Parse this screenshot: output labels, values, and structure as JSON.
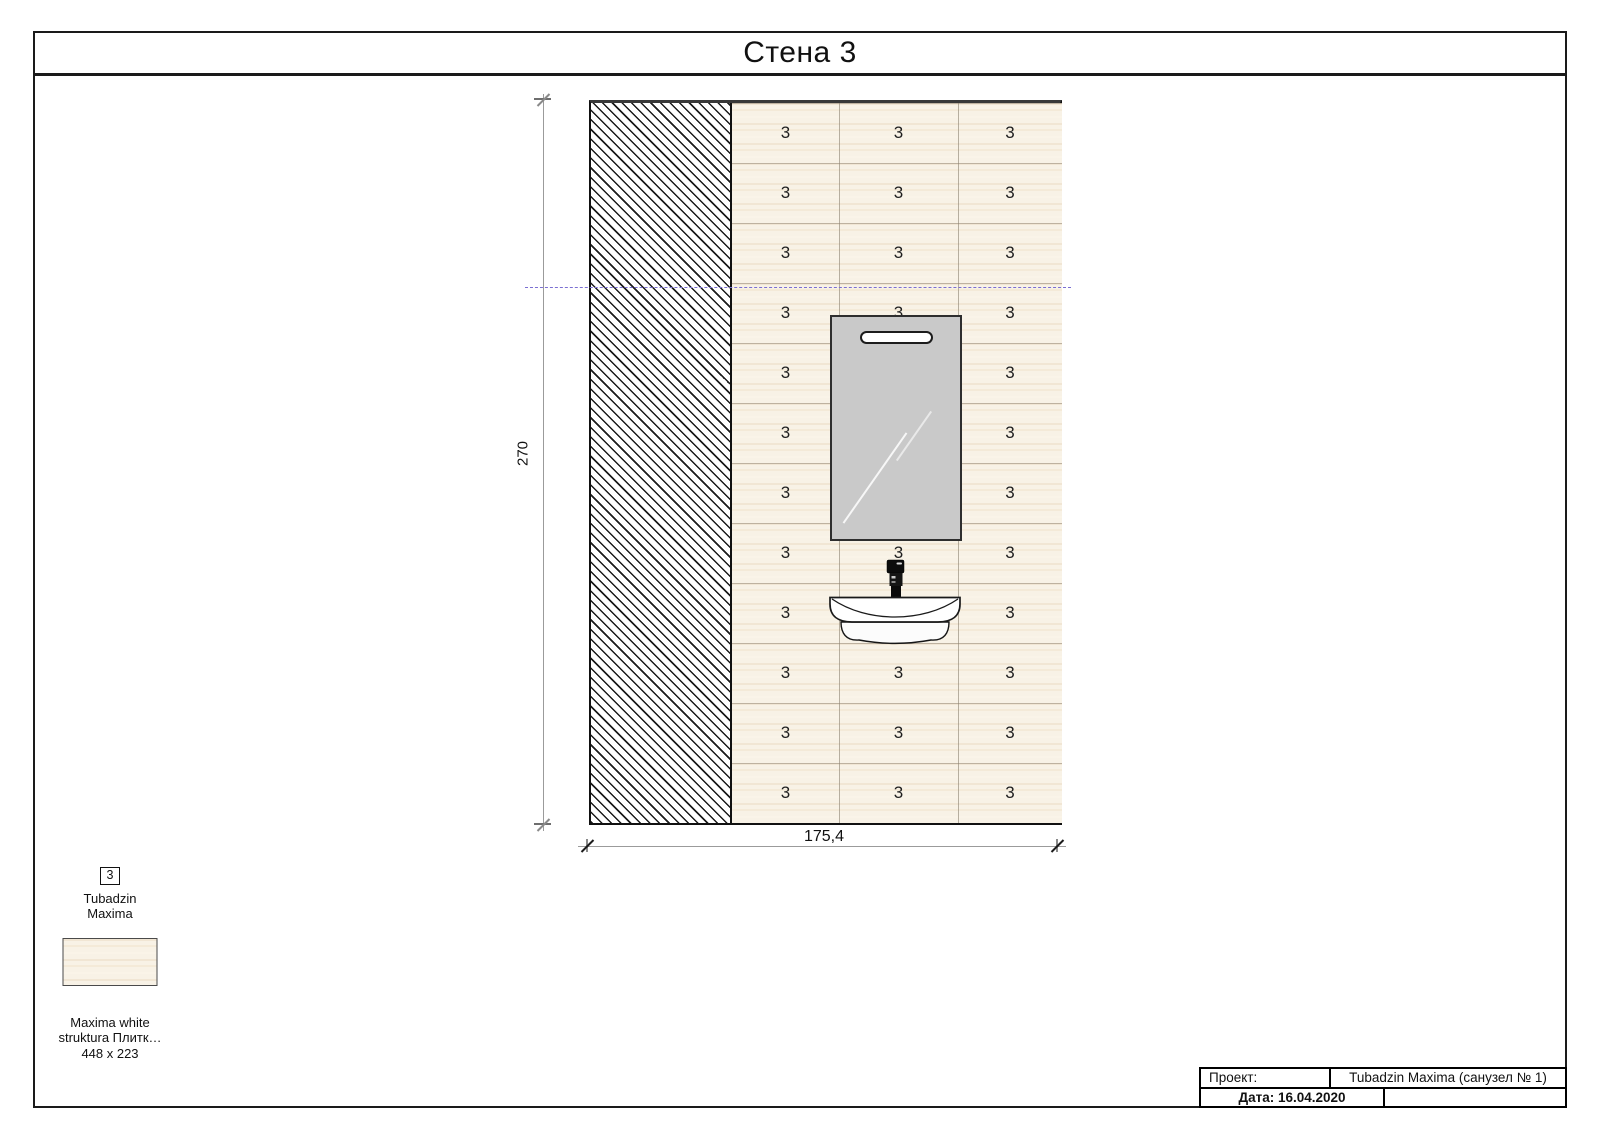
{
  "page": {
    "title": "Стена 3"
  },
  "drawing": {
    "tile_label": "3",
    "grid": {
      "rows": 12,
      "row_height": 60,
      "col_offsets": [
        0,
        107,
        226
      ],
      "col_widths": [
        107,
        119,
        104
      ]
    },
    "dimensions": {
      "height": "270",
      "width": "175,4"
    }
  },
  "legend": {
    "tile_number": "3",
    "brand": "Tubadzin\nMaxima",
    "product": "Maxima white\nstruktura  Плитк…",
    "size": "448 x 223"
  },
  "title_block": {
    "project_label": "Проект:",
    "project_value": "Tubadzin Maxima (санузел № 1)",
    "date": "Дата: 16.04.2020"
  },
  "colors": {
    "tile_base": "#f8f2e6",
    "mirror": "#c9c9c9",
    "reference_line": "#7b6fd2",
    "hatch_line": "#1b1b1b"
  }
}
